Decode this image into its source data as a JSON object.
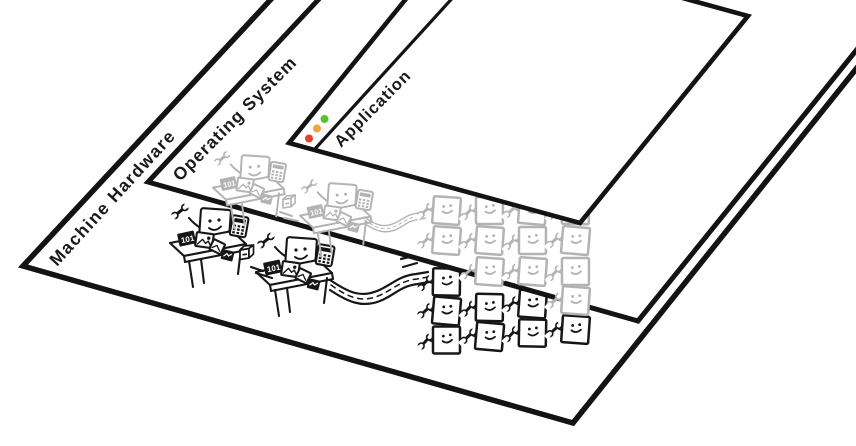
{
  "labels": {
    "hardware": "Machine Hardware",
    "os": "Operating System",
    "app": "Application"
  },
  "ink": {
    "black": "#161616",
    "gray": "#b3b3b3",
    "edge": "#131313",
    "label": "#1a1a1a"
  },
  "window": {
    "traffic_lights": [
      {
        "name": "close",
        "color": "#e2432f"
      },
      {
        "name": "minimize",
        "color": "#efa43e"
      },
      {
        "name": "zoom",
        "color": "#58c232"
      }
    ]
  },
  "scene": {
    "paper_label": "101"
  },
  "grid": {
    "cols": 4,
    "rows": [
      [
        "gray",
        "gray",
        "gray",
        "gray"
      ],
      [
        "gray",
        "gray",
        "gray",
        "gray"
      ],
      [
        "black",
        "gray",
        "gray",
        "gray"
      ],
      [
        "black",
        "black",
        "black",
        "gray"
      ],
      [
        "black",
        "black",
        "black",
        "black"
      ]
    ]
  }
}
